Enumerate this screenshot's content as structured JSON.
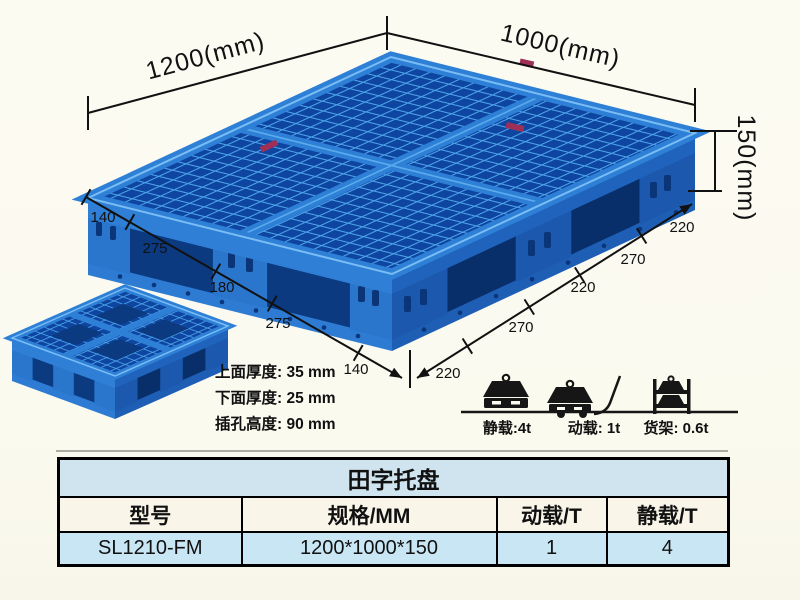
{
  "product": {
    "dims": {
      "top_left": "1200(mm)",
      "top_right": "1000(mm)",
      "height": "150(mm)"
    },
    "left_edge_segments": [
      "140",
      "275",
      "180",
      "275",
      "140"
    ],
    "right_edge_segments": [
      "220",
      "270",
      "220",
      "270",
      "220"
    ],
    "specs": {
      "top_thickness": "上面厚度: 35 mm",
      "bottom_thickness": "下面厚度: 25 mm",
      "fork_height": "插孔高度: 90 mm"
    },
    "loads": {
      "static": "静载:4t",
      "dynamic": "动载: 1t",
      "rack": "货架: 0.6t"
    }
  },
  "table": {
    "title": "田字托盘",
    "col_headers": [
      "型号",
      "规格/MM",
      "动载/T",
      "静载/T"
    ],
    "row": {
      "model": "SL1210-FM",
      "spec": "1200*1000*150",
      "dynamic_load": "1",
      "static_load": "4"
    }
  },
  "colors": {
    "pallet_blue": "#2e7fd6",
    "pallet_rib_light": "#4ba2e9",
    "pallet_hole_dark": "#0e45a0",
    "background": "#fbfaf0",
    "table_title_bg": "#cfe4ee",
    "table_header_bg": "#f9f6e9",
    "table_row_bg": "#c9e6f4"
  }
}
